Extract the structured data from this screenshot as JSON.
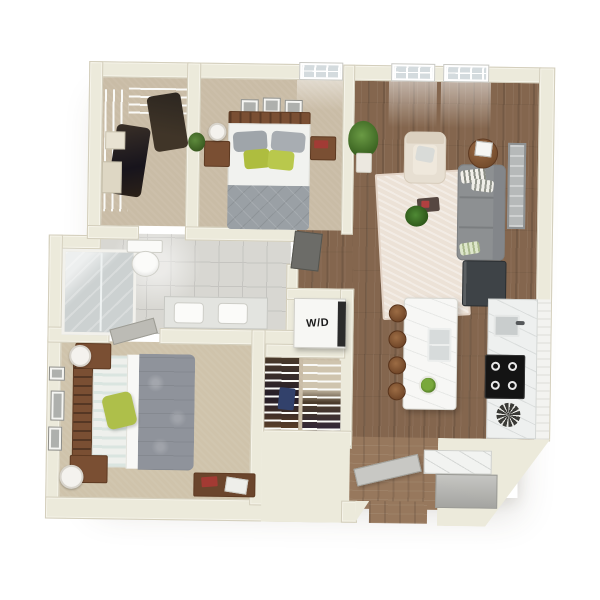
{
  "floorplan": {
    "type": "3d-apartment-floorplan",
    "washer_dryer_label": "W/D",
    "rooms": [
      "walk-in-closet",
      "bedroom-2",
      "living-room",
      "bathroom",
      "laundry-closet",
      "master-closet",
      "master-bedroom",
      "kitchen",
      "entry"
    ],
    "colors": {
      "background": "#ffffff",
      "wall": "#eceadb",
      "carpet": "#c9bca6",
      "wood_floor": "#84664e",
      "tile": "#d8d7d2",
      "sofa_gray": "#8d9092",
      "bed_gray": "#9aa0a5",
      "accent_green": "#b5c646",
      "furniture_wood": "#7a4f33",
      "appliance_black": "#141414"
    }
  }
}
